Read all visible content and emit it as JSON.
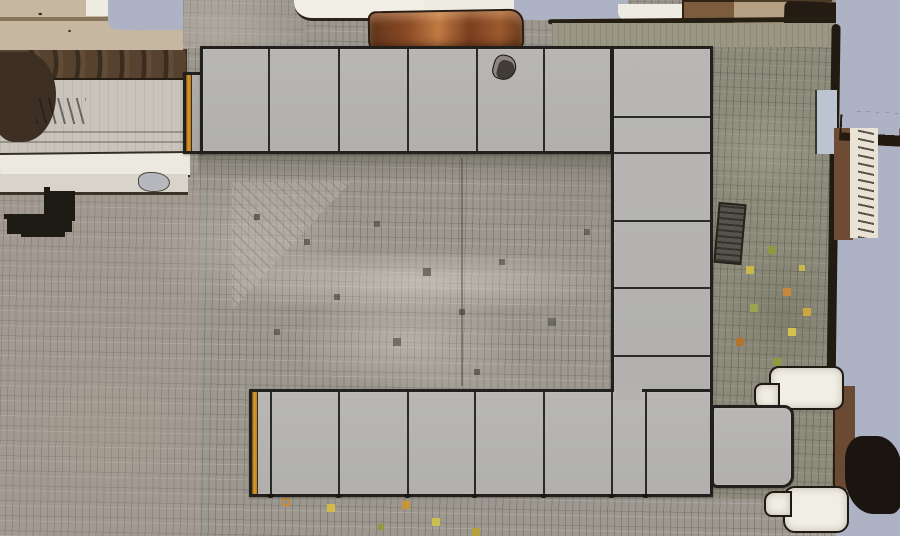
{
  "scene": {
    "title": "Aerial orthophoto of a cobbled plaza with planned market-stall modules",
    "view": "top-down aerial / orthophoto",
    "overlay": "U-shaped site-plan of flat gray stall blocks with dark outlines and orange end accents",
    "canvas": {
      "width": 900,
      "height": 536
    }
  },
  "colors": {
    "stall_fill": "#b4b3b1",
    "stall_fill_shaded": "#a8a7a5",
    "stall_border": "#21201d",
    "accent_orange": "#d89b33",
    "cobble_base": "#9c9890",
    "cobble_olive": "#8c8a7a",
    "pavement_light": "#c8c4bc",
    "sidewalk_white": "#ece9e1",
    "band_brown": "#56422f",
    "band_tan": "#c6b7a1",
    "roof_rust": "#8a4a26",
    "void_blue": "#adb2c4",
    "bench_white": "#f1eee5",
    "ink_dark": "#1a1510"
  },
  "plan": {
    "shape": "U-shape opening to the left (top row, right column, bottom row, bottom-right extension)",
    "module_counts": {
      "top_row": 6,
      "right_column": 6,
      "bottom_row": 8,
      "bottom_right_extension": 1
    },
    "segments": [
      {
        "name": "stall-endcap-top-left",
        "x": 183,
        "y": 72,
        "w": 21,
        "h": 82,
        "orange": true,
        "shaded": true
      },
      {
        "name": "stall-row-top",
        "x": 200,
        "y": 46,
        "w": 413,
        "h": 108,
        "dividers_x": [
          268,
          338,
          407,
          476,
          543
        ]
      },
      {
        "name": "stall-column-right",
        "x": 611,
        "y": 46,
        "w": 102,
        "h": 346,
        "dividers_y": [
          116,
          152,
          220,
          287,
          355
        ]
      },
      {
        "name": "stall-row-bottom",
        "x": 249,
        "y": 389,
        "w": 464,
        "h": 108,
        "dividers_x": [
          270,
          338,
          407,
          474,
          543,
          611,
          645
        ],
        "orange": true,
        "ticks": true
      },
      {
        "name": "stall-extension-bottom-right",
        "x": 711,
        "y": 405,
        "w": 83,
        "h": 83,
        "radius": "4px 10px 12px 6px"
      },
      {
        "name": "stall-corner-junction-patch",
        "x": 614,
        "y": 383,
        "w": 28,
        "h": 17,
        "patch": true
      }
    ]
  },
  "background": {
    "regions": [
      {
        "name": "cobblestone-base",
        "x": 0,
        "y": 0,
        "w": 900,
        "h": 536,
        "c": "cobbles-neutral"
      },
      {
        "name": "cobblestone-pink-tint-lower-left",
        "x": 0,
        "y": 185,
        "w": 200,
        "h": 351,
        "c": "tint-pink"
      },
      {
        "name": "right-olive-pavement-strip",
        "x": 708,
        "y": 16,
        "w": 130,
        "h": 482,
        "c": "cobbles-olive"
      },
      {
        "name": "interior-diagonal-paving-patch",
        "x": 232,
        "y": 182,
        "w": 118,
        "h": 128,
        "c": "diag-patch"
      },
      {
        "name": "shadow-below-top-row",
        "x": 198,
        "y": 150,
        "w": 418,
        "h": 30,
        "c": "shade-down"
      },
      {
        "name": "interior-light-band",
        "x": 222,
        "y": 248,
        "w": 392,
        "h": 68,
        "c": "glow-light"
      },
      {
        "name": "interior-light-patch",
        "x": 288,
        "y": 292,
        "w": 235,
        "h": 100,
        "c": "glow-light2"
      },
      {
        "name": "interior-dirt-specks",
        "x": 245,
        "y": 200,
        "w": 4,
        "h": 4,
        "c": "specks-dirt"
      },
      {
        "name": "interior-joint-line",
        "x": 461,
        "y": 158,
        "w": 2,
        "h": 228,
        "c": "joint-line"
      },
      {
        "name": "left-smooth-pavement",
        "x": 0,
        "y": 74,
        "w": 188,
        "h": 82,
        "c": "pave-light"
      },
      {
        "name": "left-joint-line-a",
        "x": 0,
        "y": 131,
        "w": 186,
        "h": 2,
        "c": "joint-h"
      },
      {
        "name": "left-joint-line-b",
        "x": 0,
        "y": 141,
        "w": 186,
        "h": 2,
        "c": "joint-h"
      },
      {
        "name": "white-sidewalk-band",
        "x": 0,
        "y": 152,
        "w": 190,
        "h": 22,
        "c": "band-white",
        "r": -0.6
      },
      {
        "name": "second-light-band",
        "x": 0,
        "y": 174,
        "w": 188,
        "h": 18,
        "c": "band-light2"
      },
      {
        "name": "gray-blob-on-band",
        "x": 138,
        "y": 172,
        "w": 30,
        "h": 18,
        "c": "blob-grayblue",
        "br": "40% 60% 50% 50%"
      },
      {
        "name": "left-brown-ledge-band",
        "x": 0,
        "y": 49,
        "w": 187,
        "h": 29,
        "c": "band-brown"
      },
      {
        "name": "left-tan-facade-band",
        "x": 0,
        "y": 0,
        "w": 183,
        "h": 50,
        "c": "band-tan"
      },
      {
        "name": "left-white-blob-top",
        "x": 86,
        "y": 0,
        "w": 38,
        "h": 16,
        "c": "blob-white"
      },
      {
        "name": "left-dark-brown-blob",
        "x": -8,
        "y": 52,
        "w": 64,
        "h": 90,
        "c": "blob-darkbrown",
        "br": "0 55% 60% 40%"
      },
      {
        "name": "top-left-pale-void",
        "x": 108,
        "y": 0,
        "w": 82,
        "h": 30,
        "c": "pale-void",
        "br": "0 0 12px 10px"
      },
      {
        "name": "graffiti-marks-left",
        "x": 36,
        "y": 98,
        "w": 50,
        "h": 26,
        "c": "marks-graffiti"
      },
      {
        "name": "dark-specks-left",
        "x": 2,
        "y": 186,
        "w": 42,
        "h": 28,
        "c": "specks-dark"
      },
      {
        "name": "top-gray-pavement",
        "x": 183,
        "y": 0,
        "w": 122,
        "h": 48,
        "c": "pave-gray cobbles-neutral"
      },
      {
        "name": "white-awning-blob",
        "x": 294,
        "y": 0,
        "w": 140,
        "h": 18,
        "c": "blob-awning",
        "br": "0 0 14px 18px"
      },
      {
        "name": "white-patch-top-mid",
        "x": 424,
        "y": 0,
        "w": 96,
        "h": 16,
        "c": "blob-white"
      },
      {
        "name": "pale-void-top-mid",
        "x": 514,
        "y": 0,
        "w": 114,
        "h": 20,
        "c": "pale-void"
      },
      {
        "name": "dark-specks-top-right",
        "x": 620,
        "y": 0,
        "w": 66,
        "h": 9,
        "c": "specks-dark-row"
      },
      {
        "name": "white-patch-top-right",
        "x": 618,
        "y": 4,
        "w": 70,
        "h": 16,
        "c": "blob-white",
        "br": "0 0 10px 8px"
      },
      {
        "name": "rust-roof-streak",
        "x": 368,
        "y": 10,
        "w": 152,
        "h": 38,
        "c": "rust-streak",
        "r": -1,
        "br": "8px 14px 10px 12px"
      },
      {
        "name": "brown-blob-top",
        "x": 682,
        "y": 0,
        "w": 58,
        "h": 24,
        "c": "blob-brown",
        "br": "0 0 40% 30%"
      },
      {
        "name": "tan-strip-top-right",
        "x": 734,
        "y": 0,
        "w": 98,
        "h": 28,
        "c": "band-tan-dark"
      },
      {
        "name": "dark-corner-blob-top-right",
        "x": 784,
        "y": 2,
        "w": 76,
        "h": 35,
        "c": "blob-ink",
        "br": "6px 10px 45% 35%",
        "r": 2
      },
      {
        "name": "plaza-edge-line-top",
        "x": 548,
        "y": 18,
        "w": 292,
        "h": 5,
        "c": "ink-line",
        "r": -0.5
      },
      {
        "name": "green-pavement-band-top",
        "x": 552,
        "y": 23,
        "w": 285,
        "h": 24,
        "c": "band-green"
      },
      {
        "name": "pale-void-right-column",
        "x": 836,
        "y": 0,
        "w": 64,
        "h": 536,
        "c": "pale-void"
      },
      {
        "name": "plaza-edge-line-right",
        "x": 829,
        "y": 24,
        "w": 9,
        "h": 372,
        "c": "ink-line-v",
        "r": 0.8
      },
      {
        "name": "blue-panel-right",
        "x": 815,
        "y": 90,
        "w": 20,
        "h": 64,
        "c": "blob-bluepanel"
      },
      {
        "name": "brown-strip-right",
        "x": 834,
        "y": 128,
        "w": 19,
        "h": 112,
        "c": "strip-brown"
      },
      {
        "name": "dark-squiggle-right",
        "x": 842,
        "y": 112,
        "w": 58,
        "h": 22,
        "c": "marks-squiggle",
        "r": 3
      },
      {
        "name": "white-scribble-strip-right",
        "x": 850,
        "y": 128,
        "w": 28,
        "h": 110,
        "c": "strip-whitescribble"
      },
      {
        "name": "brown-strip-bottom-right",
        "x": 833,
        "y": 386,
        "w": 20,
        "h": 104,
        "c": "strip-brown2"
      },
      {
        "name": "dark-blob-bottom-right",
        "x": 845,
        "y": 436,
        "w": 57,
        "h": 78,
        "c": "blob-ink2",
        "br": "30% 45% 20% 50%"
      },
      {
        "name": "stone-bench-upper",
        "x": 769,
        "y": 366,
        "w": 71,
        "h": 40,
        "c": "bench",
        "br": "10px"
      },
      {
        "name": "stone-bench-upper-tab",
        "x": 754,
        "y": 383,
        "w": 22,
        "h": 23,
        "c": "bench",
        "br": "8px 0 0 10px"
      },
      {
        "name": "stone-bench-lower",
        "x": 783,
        "y": 486,
        "w": 62,
        "h": 43,
        "c": "bench",
        "br": "12px"
      },
      {
        "name": "stone-bench-lower-tab",
        "x": 764,
        "y": 491,
        "w": 24,
        "h": 22,
        "c": "bench",
        "br": "10px 0 0 8px"
      },
      {
        "name": "leaf-specks-right-pavement",
        "x": 730,
        "y": 240,
        "w": 4,
        "h": 4,
        "c": "specks-leaves"
      },
      {
        "name": "leaf-specks-below-bottom-row",
        "x": 284,
        "y": 500,
        "w": 4,
        "h": 4,
        "c": "specks-leaves2"
      },
      {
        "name": "pavement-grate",
        "x": 716,
        "y": 203,
        "w": 24,
        "h": 57,
        "c": "grate",
        "r": 5
      }
    ]
  },
  "foreground": {
    "regions": [
      {
        "name": "small-dark-object-on-stall",
        "x": 493,
        "y": 55,
        "w": 21,
        "h": 23,
        "c": "blob-object",
        "r": 15,
        "br": "45% 55% 60% 40%"
      }
    ]
  }
}
